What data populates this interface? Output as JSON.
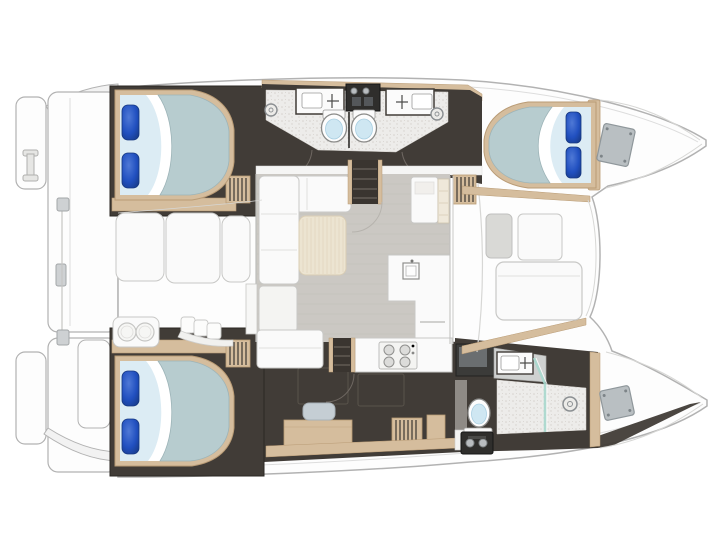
{
  "meta": {
    "name": "catamaran-interior-floor-plan",
    "view": "top-down",
    "visible_text": ""
  },
  "palette": {
    "hull_fill": "#fdfdfd",
    "hull_stroke": "#b2b2b2",
    "inner_line": "#dddddd",
    "floor_dark": "#413c37",
    "floor_dark_line": "#59534b",
    "wood": "#d5bd9d",
    "wood_dark": "#b99b75",
    "bath_floor": "#edecea",
    "bath_dot": "#d6d2cd",
    "salon_floor": "#cbc8c3",
    "salon_line": "#c0bdb7",
    "white_furn": "#fafafa",
    "furn_stroke": "#c8c8c6",
    "cream": "#ece4d1",
    "cream_line": "#ded2b9",
    "bed_sheet": "#dcecf4",
    "bed_duvet": "#b7cccf",
    "bed_duvet_edge": "#9db4b8",
    "pillow": "#2150c0",
    "pillow_dark": "#16377f",
    "pillow_light": "#4f79d6",
    "toilet_inner": "#cfe7f2",
    "glass": "#a7d8cd",
    "appliance": "#2f2e2c",
    "steel": "#b9bdc0",
    "hatch": "#b9bfc2",
    "hatch_stroke": "#8f979b",
    "cushion_gray": "#d9d9d6",
    "stool": "#c5ced4",
    "drain_stroke": "#8b8f92",
    "arc_line": "#6f6862"
  },
  "layout": {
    "vessel": "catamaran",
    "bow_direction": "right",
    "hulls": {
      "top_hull_rooms": [
        "aft double cabin",
        "twin head compartments with showers",
        "forward double cabin"
      ],
      "bottom_hull_rooms": [
        "aft double cabin",
        "corridor with desk and stool",
        "owner bathroom with shower, sink and toilet"
      ]
    },
    "bridgedeck_rooms": [
      "aft cockpit with bench seating",
      "salon with L-sofa and table",
      "galley with stove, sink and island",
      "forward lounge with sunpad"
    ]
  },
  "fixtures": {
    "double_beds": 3,
    "pillows": 6,
    "toilets": 3,
    "bathroom_sinks": 3,
    "galley_sinks": 1,
    "stove_burners": 4,
    "shower_drains": 3,
    "companionway_steps": 2,
    "cockpit_benches": 3,
    "forward_sunpads": 1,
    "bow_hatches": 2,
    "swim_platforms": 2
  }
}
